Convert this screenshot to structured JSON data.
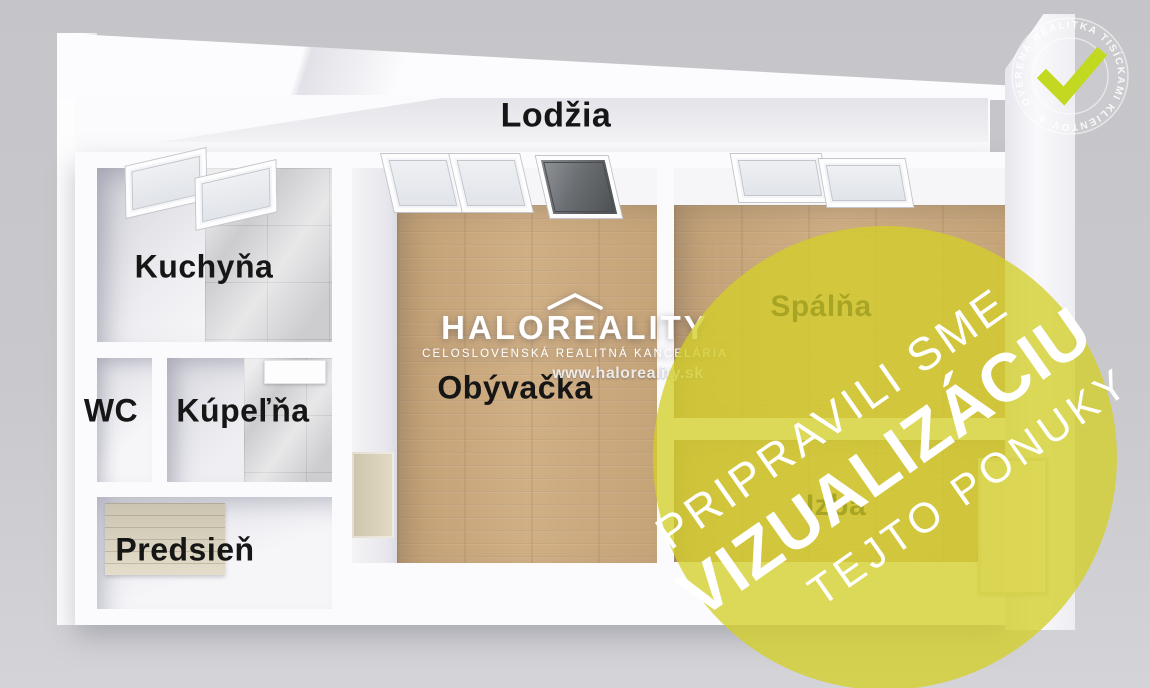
{
  "rooms": {
    "lodzia": {
      "label": "Lodžia"
    },
    "kuchyna": {
      "label": "Kuchyňa"
    },
    "wc": {
      "label": "WC"
    },
    "kupelna": {
      "label": "Kúpeľňa"
    },
    "predsien": {
      "label": "Predsieň"
    },
    "obyvacka": {
      "label": "Obývačka"
    },
    "spalna": {
      "label": "Spálňa"
    },
    "izba": {
      "label": "Izba"
    }
  },
  "watermark": {
    "brand": "HALOREALITY",
    "tagline": "CELOSLOVENSKÁ REALITNÁ KANCELÁRIA",
    "website": "www.haloreality.sk"
  },
  "overlay": {
    "line1": "PRIPRAVILI SME",
    "line2": "VIZUALIZÁCIU",
    "line3": "TEJTO PONUKY",
    "color": "#d3ce29"
  },
  "badge": {
    "ring_text": "OVERENÁ REALITKA TISÍCKAMI KLIENTOV ★",
    "checkmark_color": "#c3d820"
  },
  "colors": {
    "background": "#c9c9cd",
    "wall": "#fbfbfd",
    "wood_floor": "#c9a87d",
    "tile": "#d8d8da",
    "label_text": "#161616",
    "overlay_yellow": "#d3ce29",
    "checkmark_green": "#c3d820"
  }
}
